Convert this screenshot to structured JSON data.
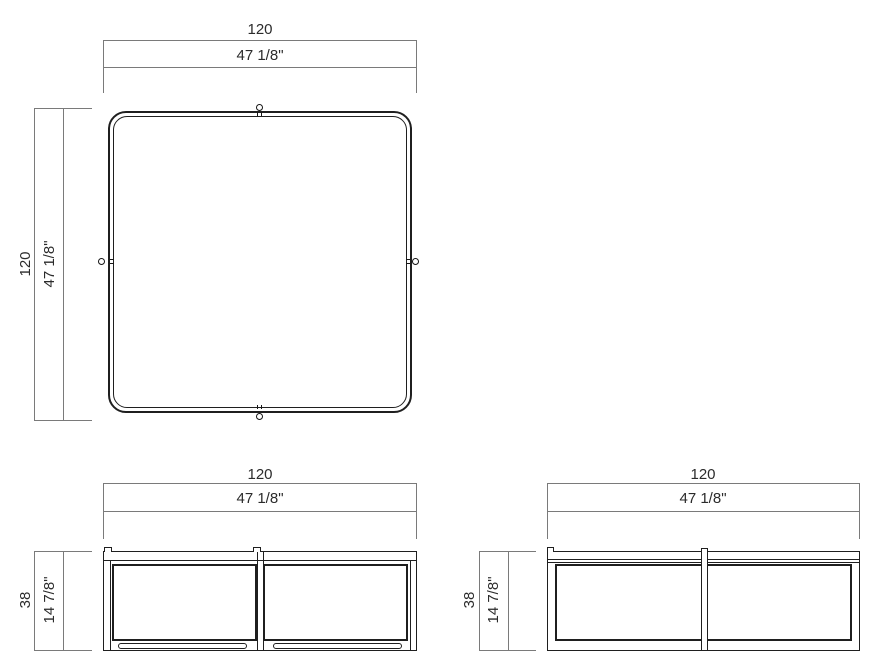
{
  "views": {
    "top": {
      "width_metric": "120",
      "width_imperial": "47 1/8\"",
      "depth_metric": "120",
      "depth_imperial": "47 1/8\""
    },
    "front": {
      "width_metric": "120",
      "width_imperial": "47 1/8\"",
      "height_metric": "38",
      "height_imperial": "14 7/8\""
    },
    "side": {
      "width_metric": "120",
      "width_imperial": "47 1/8\"",
      "height_metric": "38",
      "height_imperial": "14 7/8\""
    }
  }
}
